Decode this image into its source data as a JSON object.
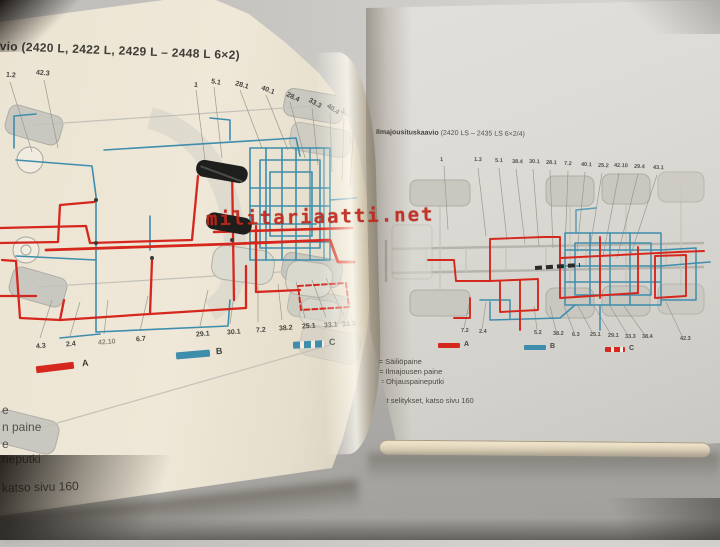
{
  "watermark": {
    "text": "militariaatti.net"
  },
  "left_page": {
    "title": "vio (2420 L, 2422 L, 2429 L – 2448 L 6×2)",
    "top_labels_left": [
      "1.2",
      "42.3"
    ],
    "top_labels": [
      "1",
      "5.1",
      "28.1",
      "40.1",
      "28.4",
      "33.3",
      "40.4",
      "30.4",
      "41.1"
    ],
    "bottom_labels": [
      "4.3",
      "2.4",
      "42.10",
      "6.7",
      "29.1",
      "30.1",
      "7.2",
      "38.2",
      "25.1",
      "33.1",
      "33.3"
    ],
    "legend": [
      "A",
      "B",
      "C"
    ],
    "footer_fragments": [
      "e",
      "n paine",
      "e",
      "neputki"
    ],
    "footer_note": "katso sivu 160"
  },
  "right_page": {
    "title_bold": "Ilmajousituskaavio",
    "title_rest": " (2420 LS – 2435 LS 6×2/4)",
    "top_labels": [
      "1",
      "1.3",
      "5.1",
      "38.4",
      "30.1",
      "28.1",
      "7.2",
      "40.1",
      "25.2",
      "42.10",
      "29.4",
      "43.1"
    ],
    "bottom_labels": [
      "7.2",
      "2.4",
      "5.2",
      "38.2",
      "6.3",
      "25.1",
      "29.1",
      "33.3",
      "38.4",
      "42.3"
    ],
    "legend": [
      "A",
      "B",
      "C"
    ],
    "legend_lines": [
      "A  =  Säiliöpaine",
      "B  =  Ilmajousen paine",
      "C  =  Ohjauspaineputki"
    ],
    "footer_note": "Muut selitykset, katso sivu 160"
  },
  "colors": {
    "line_red": "#d5271d",
    "line_blue": "#3e8dac",
    "watermark_red": "#c0271b",
    "page_left": "#ece4d3",
    "page_right": "#dbd9d4"
  }
}
